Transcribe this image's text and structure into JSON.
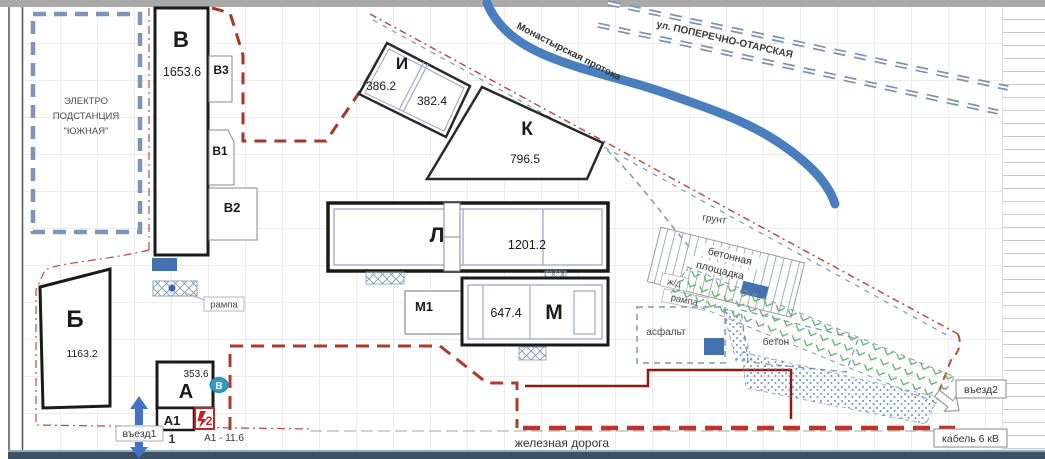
{
  "plan": {
    "substation": {
      "line1": "ЭЛЕКТРО",
      "line2": "ПОДСТАНЦИЯ",
      "line3": "\"ЮЖНАЯ\""
    },
    "street": "ул. ПОПЕРЕЧНО-ОТАРСКАЯ",
    "river": "Монастырская протока",
    "buildings": {
      "v": {
        "label": "В",
        "area": "1653.6"
      },
      "v3": {
        "label": "В3"
      },
      "v1": {
        "label": "В1"
      },
      "v2": {
        "label": "В2"
      },
      "b": {
        "label": "Б",
        "area": "1163.2"
      },
      "i": {
        "label": "И",
        "area_left": "386.2",
        "area_right": "382.4"
      },
      "k": {
        "label": "К",
        "area": "796.5"
      },
      "l": {
        "label": "Л",
        "area": "1201.2"
      },
      "m": {
        "label": "М",
        "area": "647.4"
      },
      "m1": {
        "label": "М1"
      },
      "a": {
        "label": "А",
        "area": "353.6"
      },
      "a1": {
        "label": "А1",
        "index": "1",
        "note": "А1 - 11.6"
      }
    },
    "markers": {
      "entrance1": "въезд1",
      "entrance2": "въезд2",
      "point_b": "В",
      "photo_2": "2"
    },
    "surfaces": {
      "ground": "грунт",
      "concrete_pad": {
        "line1": "бетонная",
        "line2": "площадка"
      },
      "rail_ramp": {
        "line1": "ж/д",
        "line2": "рампа"
      },
      "asphalt": "асфальт",
      "concrete": "бетон",
      "ramp": "рампа"
    },
    "lines": {
      "railway": "железная дорога",
      "cable": "кабель 6 кВ"
    },
    "colors": {
      "building_outline": "#1a1a1a",
      "inner_wall": "#9fa8cc",
      "site_boundary_red": "#a93529",
      "utility_blue": "#7f97b8",
      "river_blue": "#4a7ebf",
      "fill_blue": "#4472b0",
      "green_hatch": "#5fb06a",
      "cable_red": "#c23127",
      "marker_teal": "#2a9fc9"
    }
  }
}
